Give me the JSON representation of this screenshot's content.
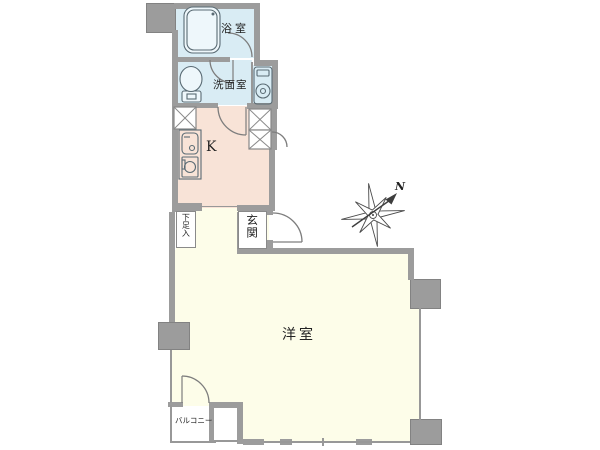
{
  "plan": {
    "rooms": {
      "bathroom": "浴室",
      "washroom": "洗面室",
      "kitchen": "K",
      "entrance": "玄関",
      "shoe_cabinet": "下足入",
      "western_room": "洋室",
      "balcony": "バルコニー"
    },
    "compass": {
      "north": "N"
    },
    "colors": {
      "wall": "#9c9c9c",
      "edge": "#828282",
      "wet": "#d9ecf4",
      "kitchen": "#f8e3d7",
      "room": "#fdfde9",
      "line": "#989898",
      "fixture": "#5a6b74",
      "text": "#222222"
    }
  }
}
